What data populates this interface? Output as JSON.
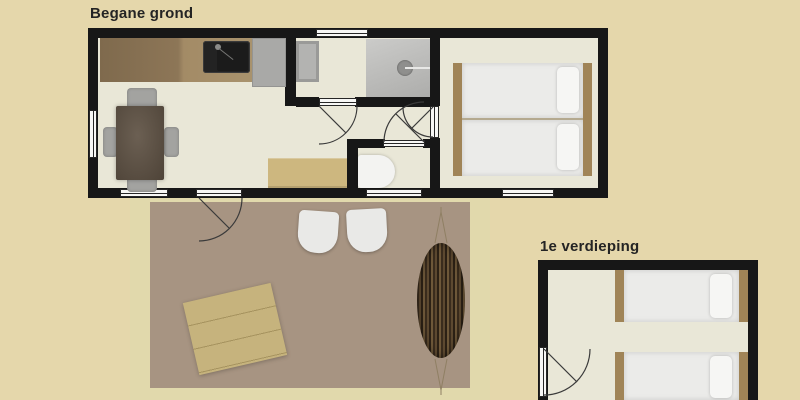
{
  "page": {
    "background_color": "#e5d7ab",
    "wall_color": "#171717",
    "floor_color": "#e9e7d7"
  },
  "floors": {
    "ground": {
      "label": "Begane grond",
      "rooms": {
        "living_kitchen": {
          "furniture": [
            "kitchen-counter",
            "kitchen-sink",
            "refrigerator",
            "dining-table",
            "dining-chairs",
            "sideboard-bench"
          ]
        },
        "bathroom": {
          "furniture": [
            "storage-cabinet",
            "shower"
          ]
        },
        "toilet_room": {
          "furniture": [
            "toilet"
          ]
        },
        "bedroom": {
          "furniture": [
            "double-bed"
          ]
        }
      }
    },
    "first": {
      "label": "1e verdieping",
      "rooms": {
        "bedroom": {
          "furniture": [
            "single-bed",
            "single-bed"
          ]
        }
      }
    },
    "terrace": {
      "furniture": [
        "garden-table",
        "garden-chair",
        "garden-chair",
        "hammock"
      ]
    }
  },
  "colors": {
    "wood_counter": "#8d7657",
    "wood_bed_frame": "#a08457",
    "terrace_deck": "#a79482",
    "terrace_rim": "#e1d9ac",
    "garden_table_wood": "#c6b37d",
    "shower_gray": "#bcbcba",
    "appliance_gray": "#a9a9a7"
  }
}
